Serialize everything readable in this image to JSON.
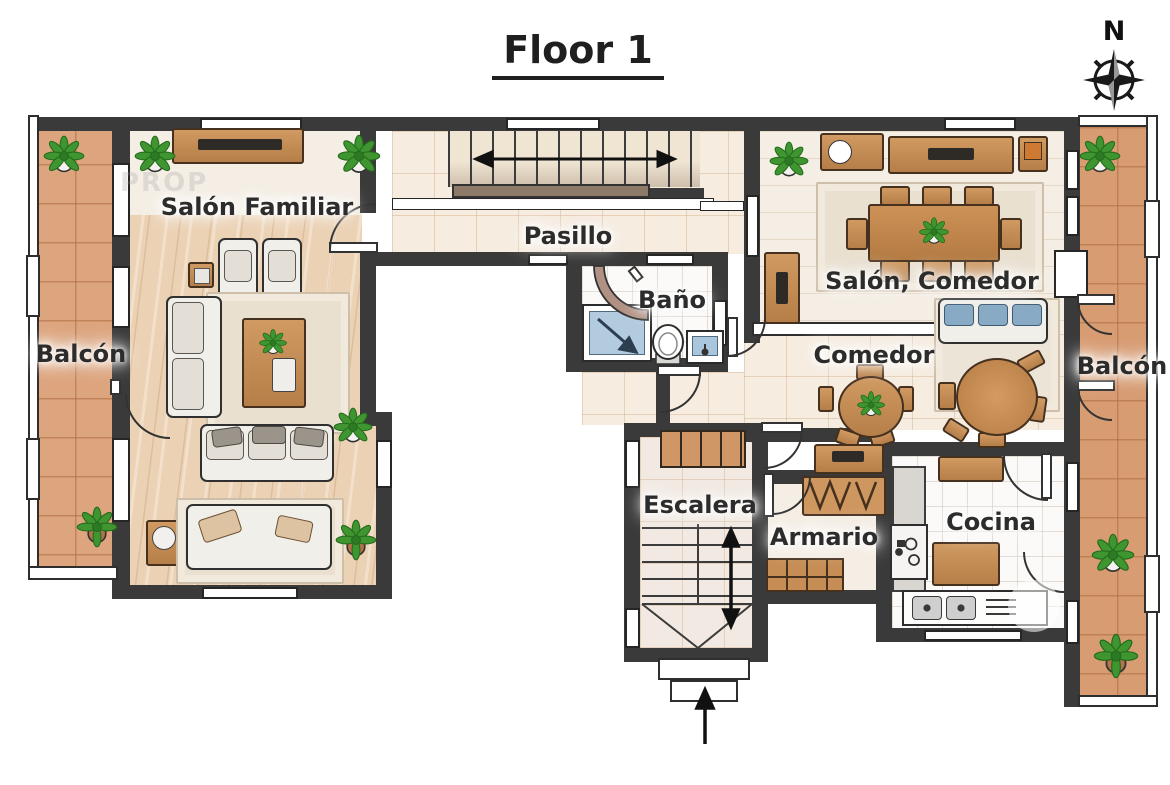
{
  "title": "Floor 1",
  "compass": {
    "north_label": "N"
  },
  "rooms": {
    "salon_familiar": "Salón Familiar",
    "balcon_left": "Balcón",
    "pasillo": "Pasillo",
    "bano": "Baño",
    "salon_comedor": "Salón, Comedor",
    "comedor": "Comedor",
    "balcon_right": "Balcón",
    "escalera": "Escalera",
    "armario": "Armario",
    "cocina": "Cocina"
  },
  "watermark": "PROP",
  "colors": {
    "wall": "#3a3a3a",
    "terracotta_floor": "#dda57e",
    "wood_floor": "#ecd2b4",
    "light_tile": "#f6ecdf",
    "furniture_wood": "#c08b5e",
    "shower_blue": "#b3cbdf",
    "plant_green": "#3f9630"
  }
}
